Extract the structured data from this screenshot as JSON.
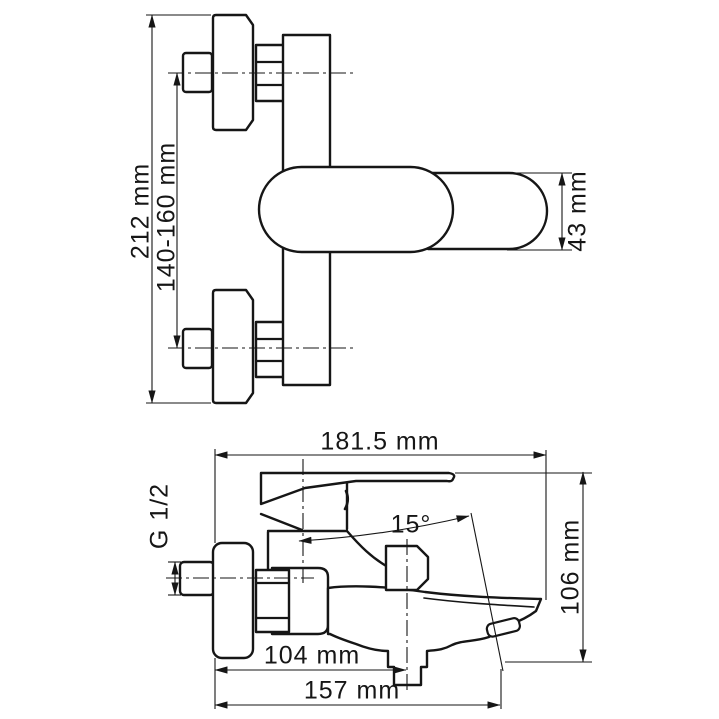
{
  "drawing": {
    "type": "technical-dimension-drawing",
    "subject": "wall-mounted bath mixer faucet",
    "front_view": {
      "height_total": "212 mm",
      "mount_spacing": "140-160 mm",
      "body_height": "43 mm"
    },
    "side_view": {
      "reach_total": "181.5 mm",
      "spout_angle": "15°",
      "thread": "G 1/2",
      "height": "106 mm",
      "reach_shower_outlet": "104 mm",
      "reach_spout": "157 mm"
    },
    "style": {
      "line_color": "#161616",
      "background": "#ffffff"
    }
  }
}
